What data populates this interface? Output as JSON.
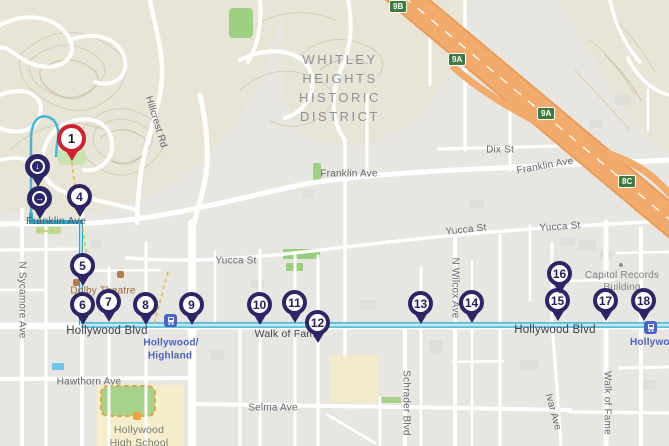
{
  "district": {
    "lines": [
      "WHITLEY",
      "HEIGHTS",
      "HISTORIC",
      "DISTRICT"
    ]
  },
  "streets": {
    "franklin": "Franklin Ave",
    "yucca": "Yucca St",
    "dix": "Dix St",
    "hollywood": "Hollywood Blvd",
    "hawthorn": "Hawthorn Ave",
    "selma": "Selma Ave",
    "sycamore": "N Sycamore Ave",
    "wilcox": "N Wilcox Ave",
    "schrader": "Schrader Blvd",
    "ivar": "Ivar Ave",
    "walk_of_fame": "Walk of Fame",
    "hillcrest": "Hillcrest Rd"
  },
  "pois": {
    "dolby": "Dolby Theatre",
    "capitol_line1": "Capitol Records",
    "capitol_line2": "Building",
    "school_line1": "Hollywood",
    "school_line2": "High School"
  },
  "transit": {
    "highland_line1": "Hollywood/",
    "highland_line2": "Highland",
    "vine": "Hollywood/V"
  },
  "shields": [
    {
      "text": "9B"
    },
    {
      "text": "9A"
    },
    {
      "text": "9A"
    },
    {
      "text": "8C"
    }
  ],
  "pins": [
    {
      "label": "1",
      "type": "start"
    },
    {
      "type": "icon",
      "glyph": "↓",
      "icon": "circle-down-arrow"
    },
    {
      "type": "icon",
      "glyph": "→",
      "icon": "circle-right-arrow"
    },
    {
      "label": "4"
    },
    {
      "label": "5"
    },
    {
      "label": "6"
    },
    {
      "label": "7"
    },
    {
      "label": "8"
    },
    {
      "label": "9"
    },
    {
      "label": "10"
    },
    {
      "label": "11"
    },
    {
      "label": "12"
    },
    {
      "label": "13"
    },
    {
      "label": "14"
    },
    {
      "label": "15"
    },
    {
      "label": "16"
    },
    {
      "label": "17"
    },
    {
      "label": "18"
    }
  ],
  "colors": {
    "route": "#2ea7c9",
    "route_inner": "#bfeaf6",
    "pin": "#2d2666",
    "pin_start": "#cf2130",
    "freeway": "#f0a565",
    "transit_blue": "#4a63c8",
    "shield_green": "#3e7b41"
  }
}
